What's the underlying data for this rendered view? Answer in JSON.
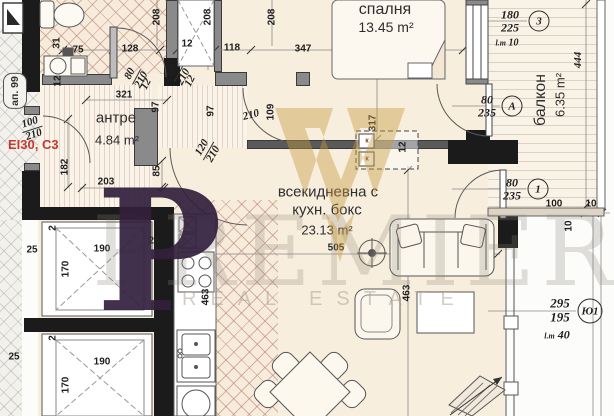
{
  "meta": {
    "apartment_label": "ап. 99",
    "fire_door_label": "EI30, C3"
  },
  "rooms": {
    "hallway": {
      "name": "антре",
      "area": "4.84 m²"
    },
    "bedroom": {
      "name": "спалня",
      "area": "13.45 m²"
    },
    "living": {
      "name_line1": "всекидневна с",
      "name_line2": "кухн. бокс",
      "area": "23.13 m²"
    },
    "balcony": {
      "name": "балкон",
      "area": "6.35 m²"
    }
  },
  "openings": {
    "window3": {
      "id": "3",
      "width": "180",
      "height": "225",
      "sill_prefix": "l.m",
      "sill": "10"
    },
    "doorA": {
      "id": "А",
      "width": "80",
      "height": "235"
    },
    "door1": {
      "id": "1",
      "width": "80",
      "height": "235"
    },
    "windowY": {
      "id": "Ю1",
      "width": "295",
      "height": "195",
      "sill_prefix": "l.m",
      "sill": "40"
    }
  },
  "doors": {
    "entry": {
      "w": "100",
      "h": "210"
    },
    "bath": {
      "w": "80",
      "h": "210"
    },
    "bedroom": {
      "w": "80",
      "h": "210"
    },
    "living": {
      "w": "120",
      "h": "210"
    }
  },
  "dims": {
    "top": [
      "128",
      "12",
      "118",
      "347"
    ],
    "v208": "208",
    "hall_width": "321",
    "hall_length": "182",
    "hall_bottom": "203",
    "d97": "97",
    "d109": "109",
    "d85": "85",
    "d31": "31",
    "d75": "75",
    "d12": "12",
    "d210": "210",
    "d2": "2",
    "bedroom_depth": "317",
    "living_width": "505",
    "d463": "463",
    "balcony_length": "444",
    "balc_100": "100",
    "balc_10": "10",
    "elev_25": "25",
    "elev_190": "190",
    "elev_170": "170"
  },
  "furniture": {
    "wardrobe_mark": "к"
  },
  "watermark": {
    "monogram": "P",
    "title": "PREMIER",
    "subtitle": "REAL ESTATE"
  },
  "colors": {
    "wall": "#1b1b1b",
    "fire_label": "#c43a2e",
    "floor": "#f8eede",
    "gold": "#c59a3f",
    "purple": "#33203d"
  }
}
